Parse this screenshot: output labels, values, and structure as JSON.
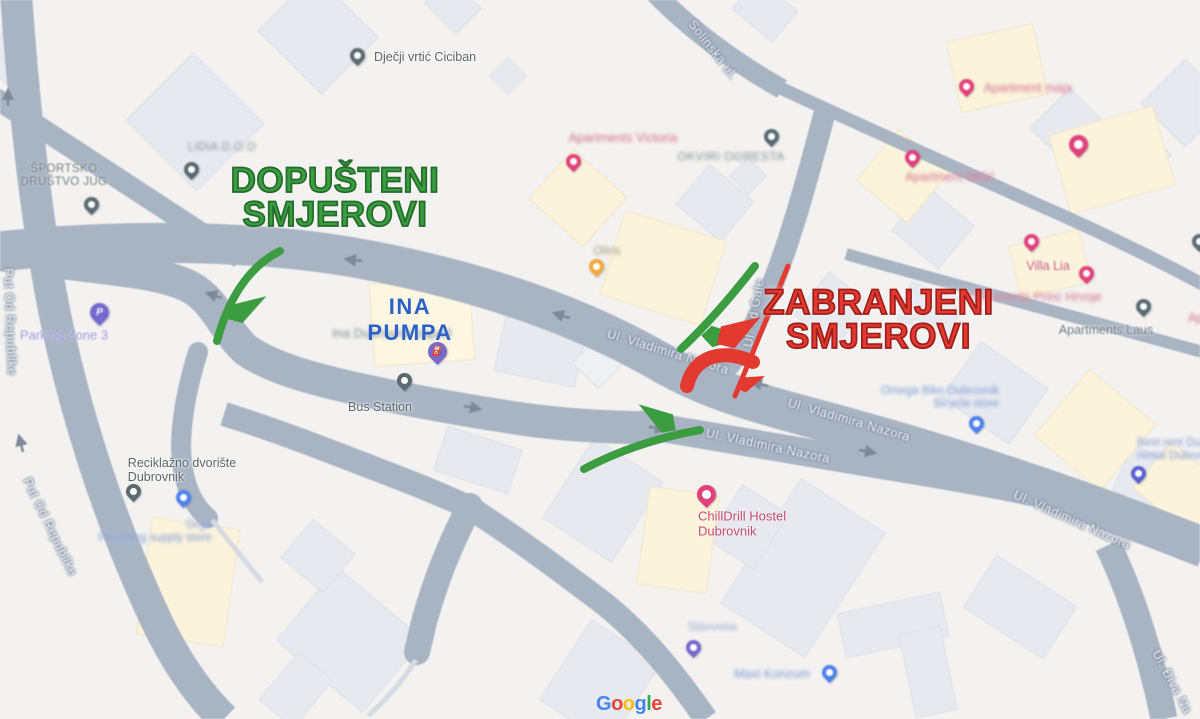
{
  "annotations": {
    "allowed": {
      "line1": "DOPUŠTENI",
      "line2": "SMJEROVI"
    },
    "forbidden": {
      "line1": "ZABRANJENI",
      "line2": "SMJEROVI"
    }
  },
  "streets": {
    "solinska": "Solinska ul.",
    "od_gale": "Ul. od Gale",
    "vladimira_nazora": "Ul. Vladimira Nazora",
    "put_od_republike": "Put Od Republike",
    "diva": "Ul. Điva Na"
  },
  "pois": {
    "djecji_vrtic": {
      "name": "Dječji vrtić Ciciban"
    },
    "sportsko": {
      "line1": "ŠPORTSKO",
      "line2": "DRUŠTVO JUG"
    },
    "lidia": {
      "name": "LIDIA D.O.O"
    },
    "apartments_victoria": {
      "name": "Apartments Victoria"
    },
    "okviri_ogresta": {
      "name": "OKVIRI OGRESTA"
    },
    "oliris": {
      "name": "Oliris"
    },
    "apartment_maja": {
      "name": "Apartment maja"
    },
    "apartment_misic": {
      "name": "Apartment Mišić"
    },
    "villa_lia": {
      "name": "Villa Lia"
    },
    "apartments_princ": {
      "name": "Apartments Princ Hrvoje"
    },
    "apartments_laus": {
      "name": "Apartments Laus"
    },
    "edge_apartment": {
      "name": "Ap"
    },
    "ina_pumpa": {
      "line1": "INA",
      "line2": "PUMPA"
    },
    "ina_dubrovnik": {
      "name": "Ina Dubrovnik zapad"
    },
    "bus_station": {
      "name": "Bus Station"
    },
    "parking_zone": {
      "name": "Parking Zone 3",
      "pin_letter": "P"
    },
    "reciklazno": {
      "line1": "Reciklažno dvorište",
      "line2": "Dubrovnik"
    },
    "grga": {
      "line1": "Grga",
      "line2": "Plumbing supply store"
    },
    "omega_bike": {
      "line1": "Omega Bike Dubrovnik",
      "line2": "Bicycle store"
    },
    "best_rent": {
      "line1": "Best rent Dubrovnik",
      "line2": "rental Dubrovnik"
    },
    "chilldrill": {
      "line1": "ChillDrill Hostel",
      "line2": "Dubrovnik"
    },
    "stavvieta": {
      "name": "Stāvvieta"
    },
    "maxi_konzum": {
      "name": "Maxi Konzum"
    }
  },
  "colors": {
    "allowed_green": "#3b9c40",
    "allowed_outline": "#226b2a",
    "forbidden_red": "#e23a31",
    "forbidden_outline": "#9e1d18",
    "road": "#a9b4c3",
    "background": "#f3f2f0",
    "building": "#e7e9ee",
    "landmark_building": "#fbf3dc",
    "ina_label_blue": "#2a62c9",
    "google_blue": "#4285F4",
    "google_red": "#EA4335",
    "google_yellow": "#FBBC05",
    "google_green": "#34A853"
  },
  "attribution": {
    "letters": [
      "G",
      "o",
      "o",
      "g",
      "l",
      "e"
    ]
  }
}
